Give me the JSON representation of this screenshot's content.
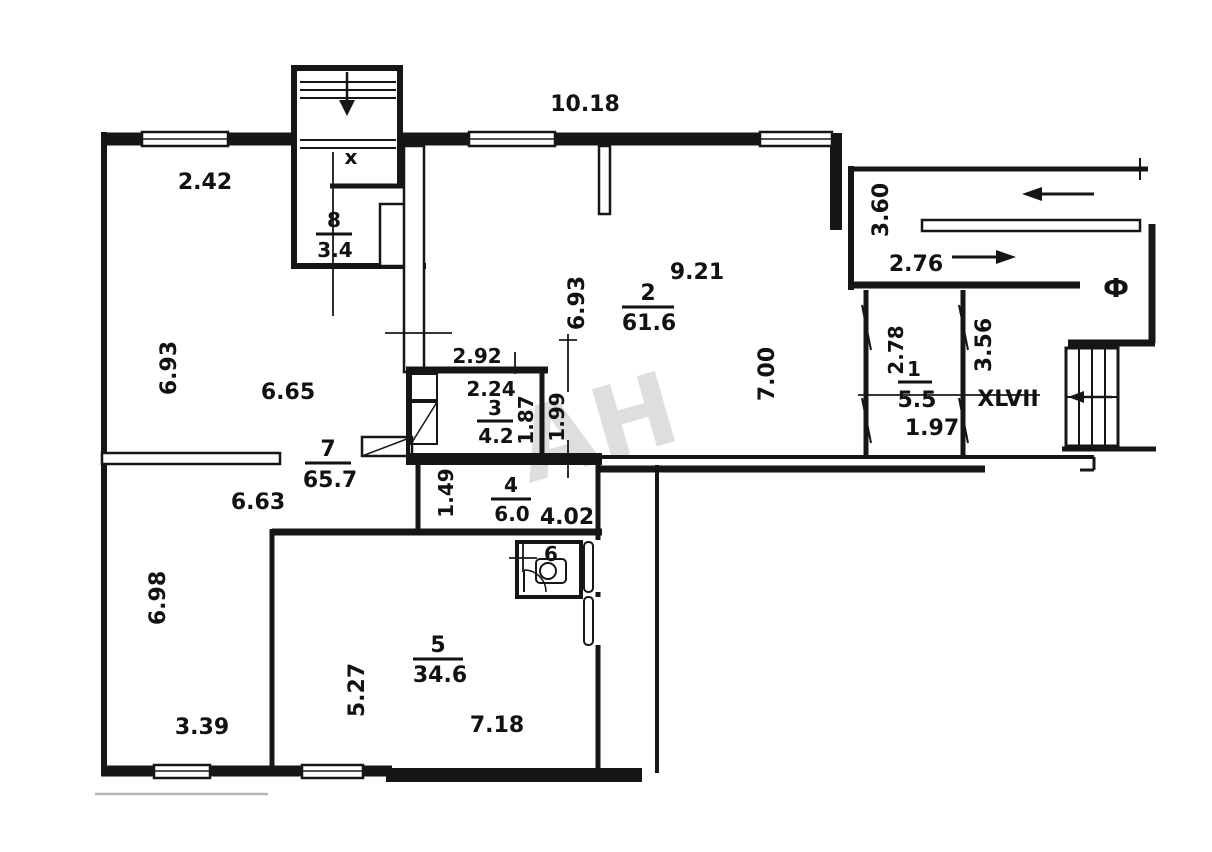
{
  "plan": {
    "unit_number": "XLVII",
    "watermark": "АН",
    "marks": {
      "entry_vestibule": "x",
      "elevator": "Ф"
    },
    "rooms": {
      "r1": {
        "number": "1",
        "area": "5.5"
      },
      "r2": {
        "number": "2",
        "area": "61.6"
      },
      "r3": {
        "number": "3",
        "area": "4.2"
      },
      "r4": {
        "number": "4",
        "area": "6.0"
      },
      "r5": {
        "number": "5",
        "area": "34.6"
      },
      "r6": {
        "number": "6"
      },
      "r7": {
        "number": "7",
        "area": "65.7"
      },
      "r8": {
        "number": "8",
        "area": "3.4"
      }
    },
    "dims": {
      "top_width": "10.18",
      "left_top_width": "2.42",
      "left_height": "6.93",
      "hall_width": "6.65",
      "lower_left_width": "6.63",
      "lower_left_height": "6.98",
      "lower_left_bottom": "3.39",
      "room5_height": "5.27",
      "room5_width": "7.18",
      "room2_left_height": "6.93",
      "room2_top": "9.21",
      "room2_right_height": "7.00",
      "room3_top": "2.92",
      "room3_width": "2.24",
      "room3_height": "1.87",
      "passage_width": "1.99",
      "room4_height": "1.49",
      "room4_width": "4.02",
      "corridor_top": "3.60",
      "corridor_mid": "2.76",
      "room1_height": "2.78",
      "room1_width": "1.97",
      "hall_right_height": "3.56"
    }
  }
}
